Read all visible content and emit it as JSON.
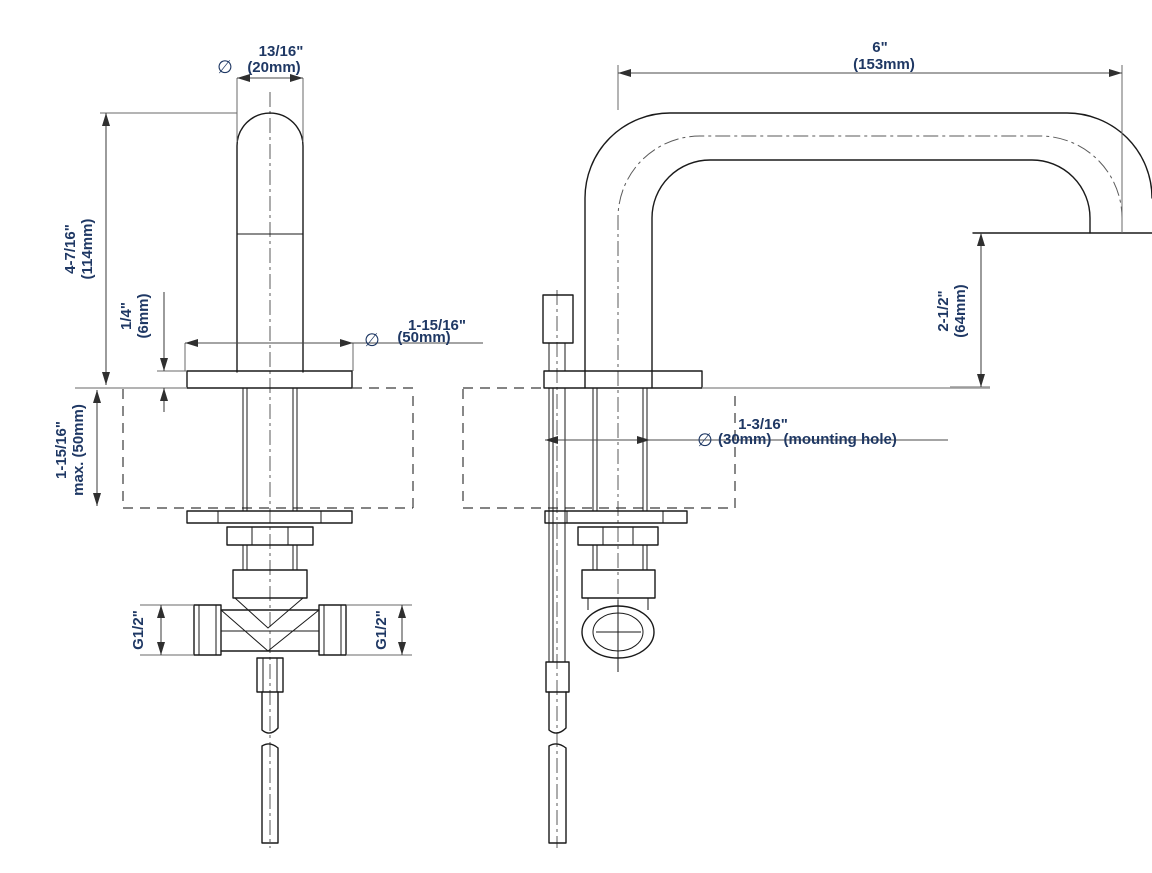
{
  "colors": {
    "background": "#ffffff",
    "outline": "#1a1a1a",
    "dimension_line": "#4a4a4a",
    "dimension_text": "#1f3864"
  },
  "front": {
    "handle_dia_sym": "∅",
    "handle_dia_in": "13/16\"",
    "handle_dia_mm": "(20mm)",
    "height_in": "4-7/16\"",
    "height_mm": "(114mm)",
    "plate_in": "1/4\"",
    "plate_mm": "(6mm)",
    "deck_in": "1-15/16\"",
    "deck_mm": "max. (50mm)",
    "base_sym": "∅",
    "base_in": "1-15/16\"",
    "base_mm": "(50mm)",
    "g_left": "G1/2\"",
    "g_right": "G1/2\""
  },
  "side": {
    "reach_in": "6\"",
    "reach_mm": "(153mm)",
    "height_in": "2-1/2\"",
    "height_mm": "(64mm)",
    "hole_in": "1-3/16\"",
    "hole_sym": "∅",
    "hole_mm": "(30mm)",
    "hole_note": "(mounting hole)"
  }
}
